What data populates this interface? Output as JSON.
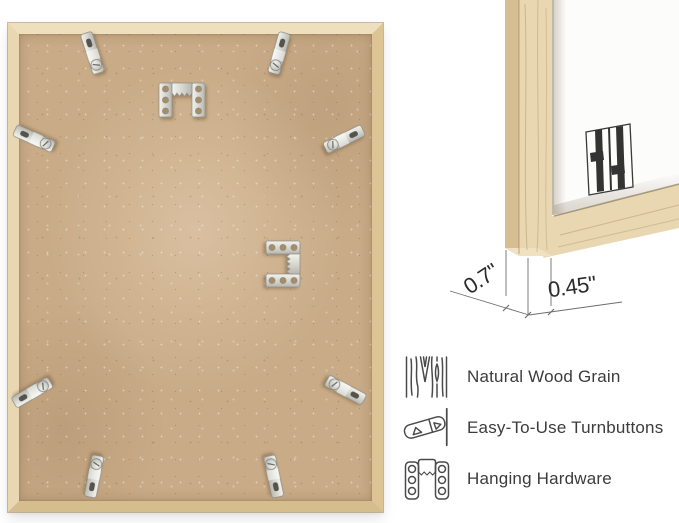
{
  "colors": {
    "background": "#ffffff",
    "frame_wood": "#e8d5ae",
    "backing_board": "#c9ab87",
    "metal_hardware": "#d9d9d4",
    "feature_text": "#3c3c3c",
    "dimension_text": "#2b2b2b",
    "logo": "#333333"
  },
  "back_view": {
    "name": "frame-back-photo",
    "turnbutton_count": 8,
    "sawtooth_hanger_count": 2
  },
  "corner_view": {
    "name": "frame-corner-photo",
    "logo": "double-h-brand-logo"
  },
  "dimensions": {
    "depth": "0.7\"",
    "face_width": "0.45\""
  },
  "features": [
    {
      "icon": "wood-grain-icon",
      "label": "Natural Wood Grain"
    },
    {
      "icon": "turnbutton-icon",
      "label": "Easy-To-Use Turnbuttons"
    },
    {
      "icon": "hanging-hardware-icon",
      "label": "Hanging Hardware"
    }
  ]
}
